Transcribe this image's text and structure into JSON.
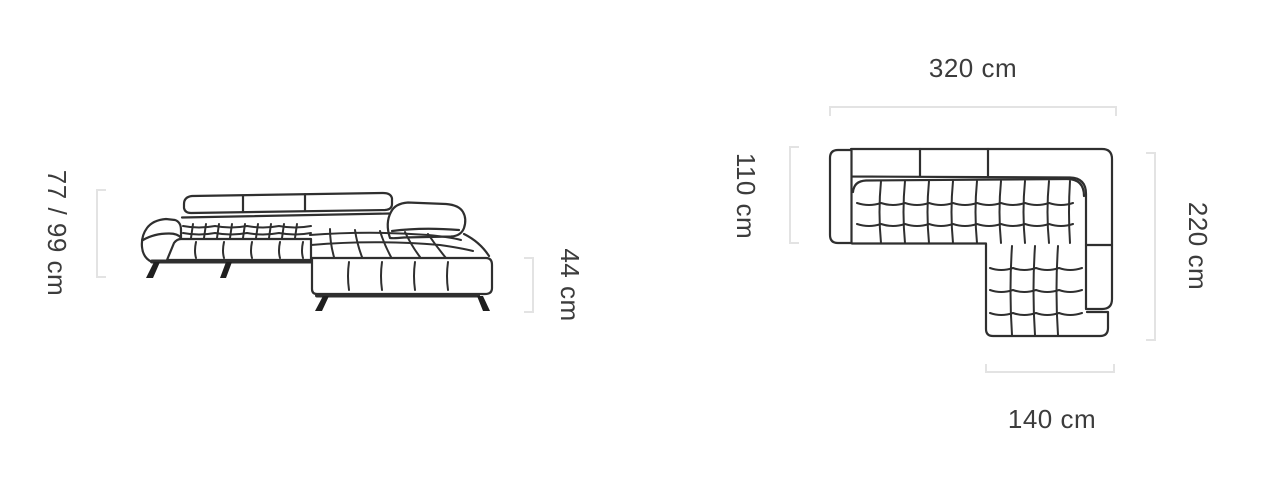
{
  "diagram": {
    "front_view": {
      "height_label": "77 / 99 cm",
      "seat_height_label": "44 cm"
    },
    "top_view": {
      "width_label": "320 cm",
      "depth_label": "110 cm",
      "length_label": "220 cm",
      "chaise_width_label": "140 cm"
    }
  },
  "colors": {
    "sofa_line": "#2f2f2f",
    "dimension_bracket": "#e3e3e3",
    "label_text": "#3c3c3c",
    "background": "#ffffff"
  }
}
